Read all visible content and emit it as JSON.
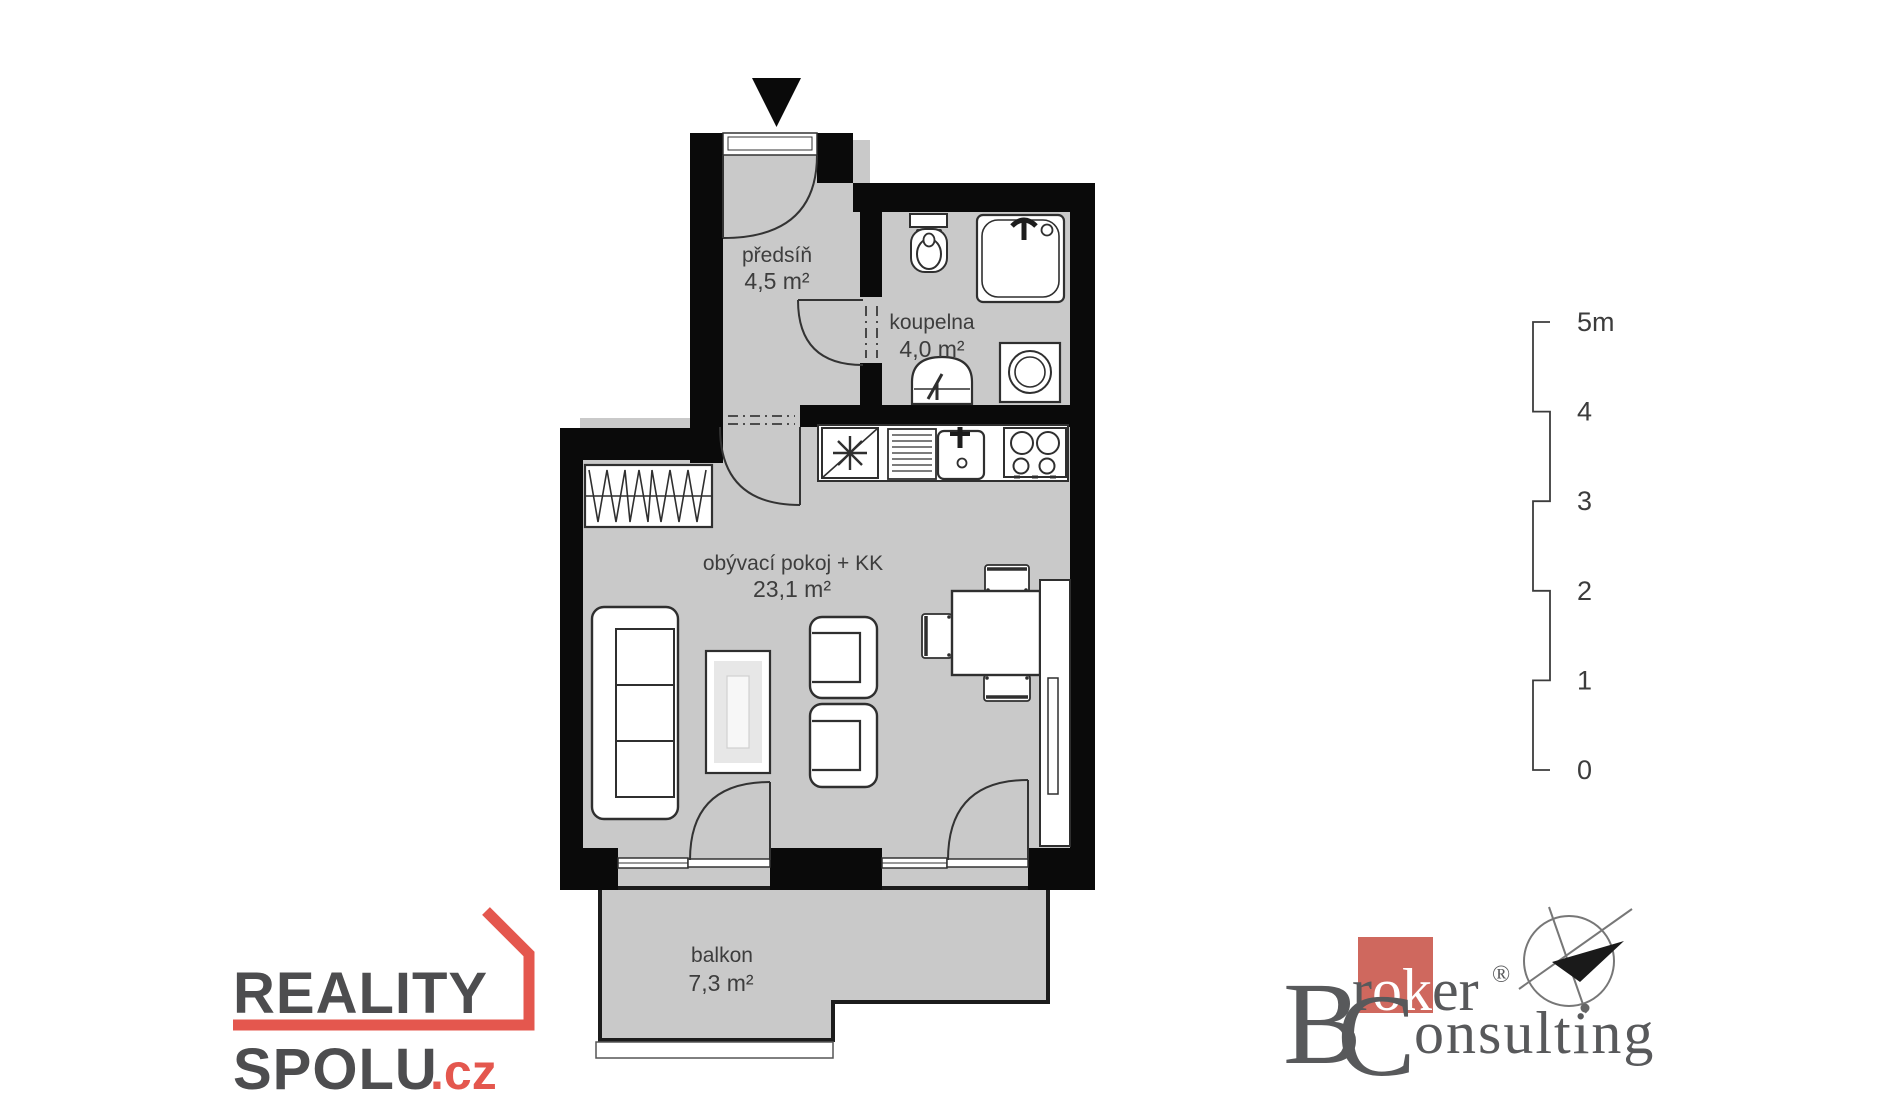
{
  "rooms": {
    "predsin": {
      "name": "předsíň",
      "area": "4,5 m²"
    },
    "koupelna": {
      "name": "koupelna",
      "area": "4,0 m²"
    },
    "obyvaci": {
      "name": "obývací pokoj + KK",
      "area": "23,1 m²"
    },
    "balkon": {
      "name": "balkon",
      "area": "7,3 m²"
    }
  },
  "scale_bar": {
    "m5": "5m",
    "m4": "4",
    "m3": "3",
    "m2": "2",
    "m1": "1",
    "m0": "0"
  },
  "logos": {
    "reality_spolu": {
      "line1": "REALITY",
      "line2": "SPOLU",
      "tld": ".cz"
    },
    "broker": {
      "b": "B",
      "r": "r",
      "ok": "ok",
      "er": "er",
      "reg": "®",
      "c": "C",
      "onsulting": "onsulting"
    }
  },
  "colors": {
    "floor": "#c9c9c9",
    "wall": "#0a0a0a",
    "fixture_outline": "#2f2f2f",
    "label_text": "#3d3d3d",
    "reality_red": "#e4574e",
    "reality_gray": "#4d4d4f",
    "broker_gray": "#58595b",
    "broker_red": "#cf685e"
  }
}
